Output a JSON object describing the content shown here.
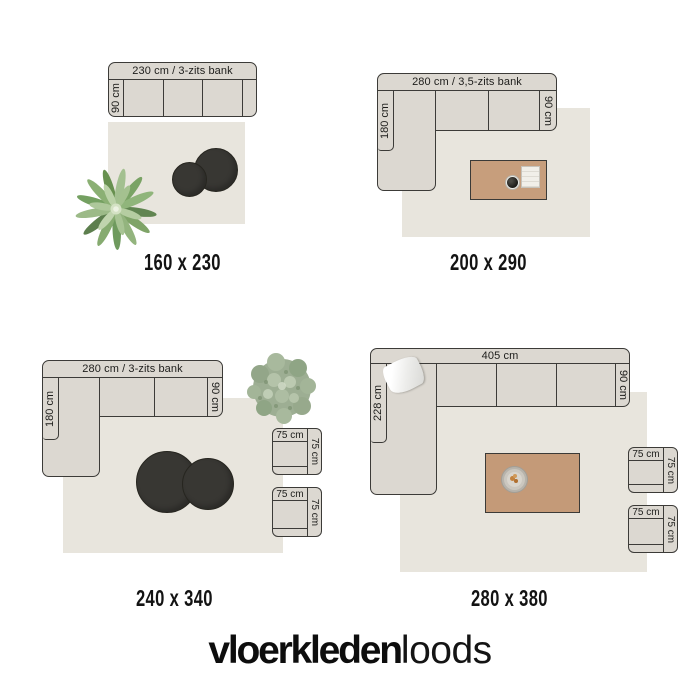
{
  "brand": {
    "name_bold": "vloerkleden",
    "name_light": "loods"
  },
  "colors": {
    "background": "#ffffff",
    "sofa_fill": "#dcd8d1",
    "rug_fill": "#e8e5dd",
    "outline": "#3c3b38",
    "pouf_fill": "#383733",
    "table_fill_top": "#c79e7c",
    "table_fill_bottom": "#c49a78",
    "text": "#1d1d1b"
  },
  "panels": [
    {
      "size_label": "160 x 230",
      "sofa": {
        "type": "straight-3-seat",
        "top_label": "230 cm / 3-zits bank",
        "side_label": "90 cm"
      },
      "accessories": [
        "plant",
        "pouf-large",
        "pouf-small"
      ]
    },
    {
      "size_label": "200 x 290",
      "sofa": {
        "type": "corner",
        "top_label": "280 cm / 3,5-zits bank",
        "left_label": "180 cm",
        "right_label": "90 cm"
      },
      "accessories": [
        "coffee-table",
        "bowl",
        "book"
      ]
    },
    {
      "size_label": "240 x 340",
      "sofa": {
        "type": "corner",
        "top_label": "280 cm / 3-zits bank",
        "left_label": "180 cm",
        "right_label": "90 cm"
      },
      "chairs": [
        {
          "top_label": "75 cm",
          "side_label": "75 cm"
        },
        {
          "top_label": "75 cm",
          "side_label": "75 cm"
        }
      ],
      "accessories": [
        "plant",
        "pouf-large",
        "pouf-small"
      ]
    },
    {
      "size_label": "280 x 380",
      "sofa": {
        "type": "corner",
        "top_label": "405 cm",
        "left_label": "228 cm",
        "right_label": "90 cm"
      },
      "chairs": [
        {
          "top_label": "75 cm",
          "side_label": "75 cm"
        },
        {
          "top_label": "75 cm",
          "side_label": "75 cm"
        }
      ],
      "accessories": [
        "pillow",
        "coffee-table",
        "fruit-plate"
      ]
    }
  ]
}
